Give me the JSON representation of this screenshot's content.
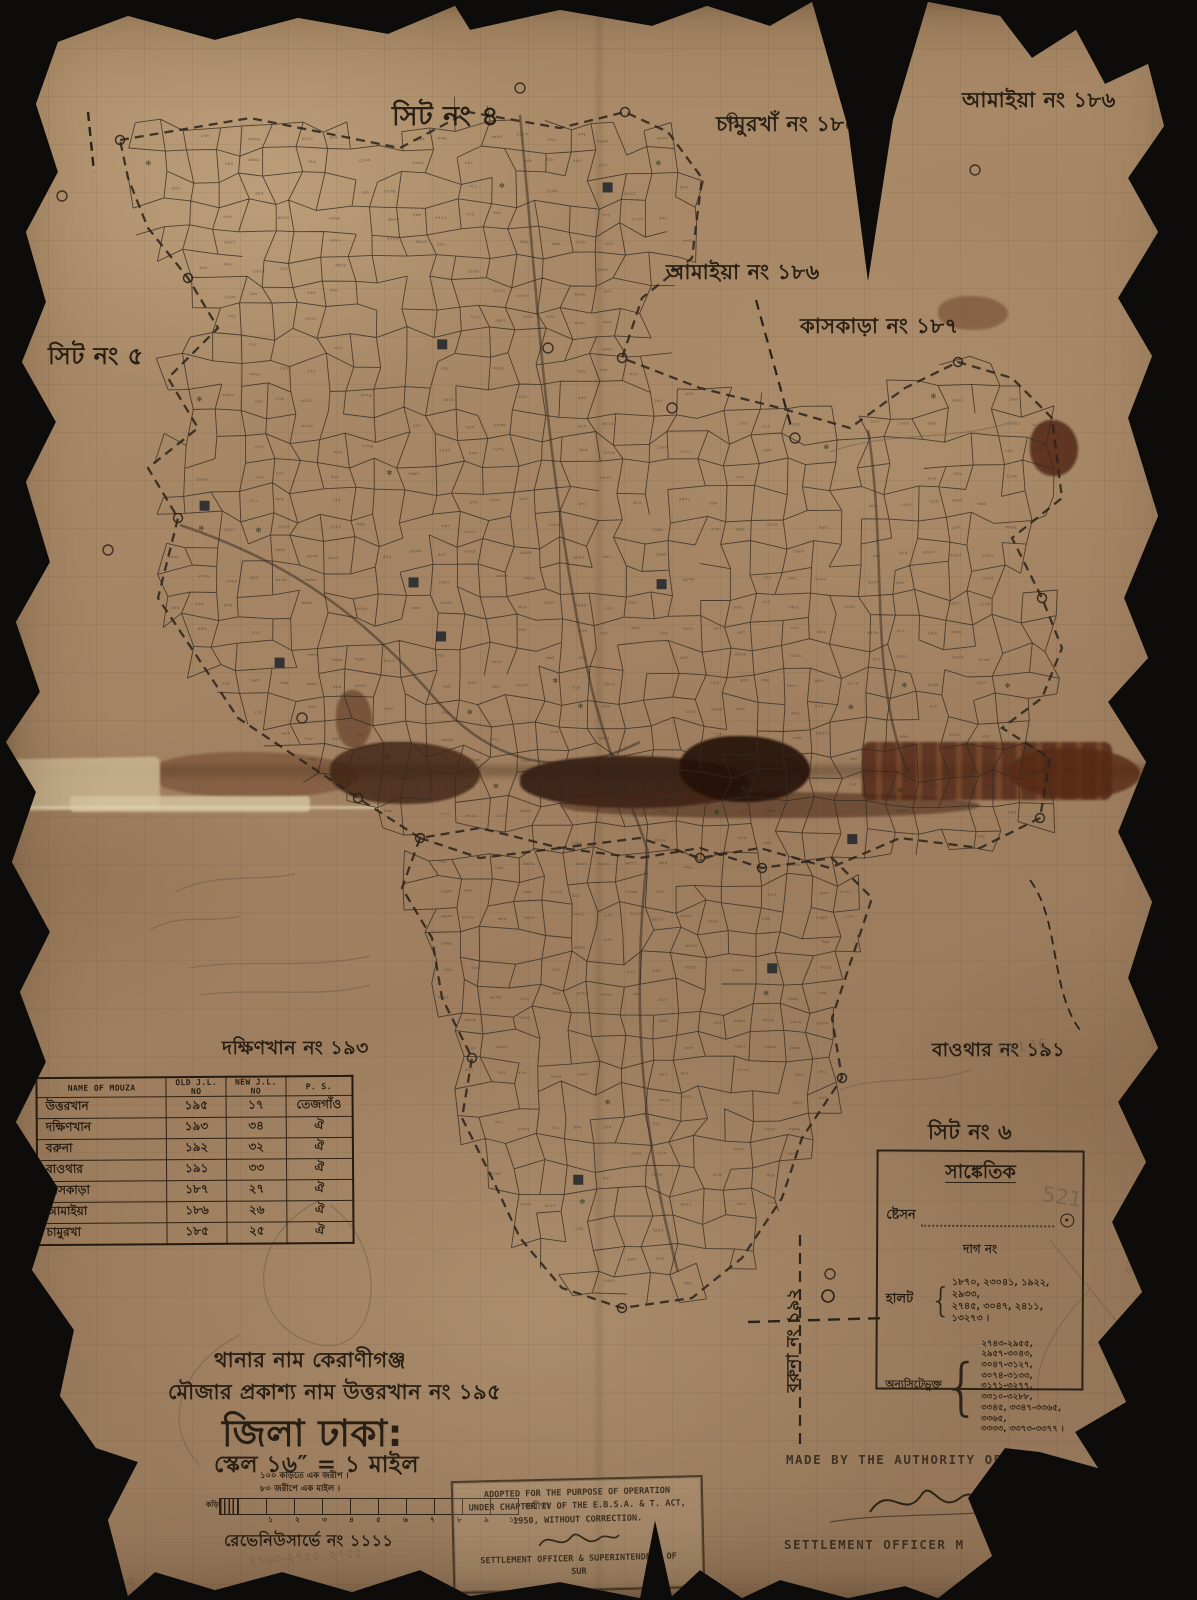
{
  "colors": {
    "background": "#0d0c0a",
    "paper": "#a4855f",
    "ink": "#241c12",
    "typed_ink": "#3e3122",
    "pencil": "#6d5b46"
  },
  "map_labels": {
    "sheet_no_4": "সিট নং ৪",
    "sheet_no_5": "সিট নং ৫",
    "sheet_no_6": "সিট নং ৬",
    "chamurkha_185": "চামুরখাঁ নং ১৮৫",
    "amaiya_186_top": "আমাইয়া নং ১৮৬",
    "amaiya_186_mid": "আমাইয়া নং ১৮৬",
    "kaskara_187": "কাসকাড়া নং ১৮৭",
    "dakshinkhan_193": "দক্ষিণখান নং ১৯৩",
    "baothar_191": "বাওথার নং ১৯১",
    "baruna_192_vertical": "বরুনা নং ১৯২"
  },
  "mouza_table": {
    "headers": [
      "NAME OF MOUZA",
      "OLD J.L. NO",
      "NEW J.L. NO",
      "P. S."
    ],
    "rows": [
      {
        "name": "উত্তরখান",
        "old_jl": "১৯৫",
        "new_jl": "১৭",
        "ps": "তেজগাঁও"
      },
      {
        "name": "দক্ষিণখান",
        "old_jl": "১৯৩",
        "new_jl": "৩৪",
        "ps": "ঐ"
      },
      {
        "name": "বরুনা",
        "old_jl": "১৯২",
        "new_jl": "৩২",
        "ps": "ঐ"
      },
      {
        "name": "বাওথার",
        "old_jl": "১৯১",
        "new_jl": "৩৩",
        "ps": "ঐ"
      },
      {
        "name": "কাসকাড়া",
        "old_jl": "১৮৭",
        "new_jl": "২৭",
        "ps": "ঐ"
      },
      {
        "name": "আমাইয়া",
        "old_jl": "১৮৬",
        "new_jl": "২৬",
        "ps": "ঐ"
      },
      {
        "name": "চামুরখা",
        "old_jl": "১৮৫",
        "new_jl": "২৫",
        "ps": "ঐ"
      }
    ]
  },
  "legend": {
    "title": "সাঙ্কেতিক",
    "station_label": "ষ্টেসন",
    "dag_no_label": "দাগ নং",
    "halot_label": "হালট",
    "halot_numbers_line1": "১৮৭০, ২৩০৪১, ১৯২২, ২৯৩৩,",
    "halot_numbers_line2": "২৭৪৫, ৩০৪৭, ২৪১১, ১৩২৭৩ ।",
    "other_sheet_label": "অন্যসিটেভুক্ত",
    "other_sheet_line1": "২৭৪৩-২৯৫৫, ২৯৫৭-৩০৪৩,",
    "other_sheet_line2": "৩০৪৭-৩১২৭, ৩০৭৪-৩১৩৩,",
    "other_sheet_line3": "৩১৭১-৩২৭৭, ৩৩১০-৩২৮৮,",
    "other_sheet_line4": "৩৩৪৫, ৩৩৪৭-৩৩৬৫, ৩৩৬৫,",
    "other_sheet_line5": "৩৩৩৩, ৩৩৭৩-৩৩৭৭ ।"
  },
  "title_block": {
    "thana_line": "থানার নাম কেরাণীগঞ্জ",
    "mouza_line": "মৌজার প্রকাশ্য নাম  উত্তরখান নং ১৯৫",
    "district_line": "জিলা ঢাকা:",
    "scale_line": "স্কেল ১৬″ = ১ মাইল",
    "revenue_survey_line": "রেভেনিউসার্ভে নং ১১১১"
  },
  "scale_bar": {
    "caption_line1": "১০০ কড়িতে এক জরীপ  ।",
    "caption_line2": "৮০ জরীপে এক মাইল  ।",
    "left_label": "কড়ি",
    "right_label": "জরীপ।",
    "ticks": [
      "১",
      "২",
      "৩",
      "৪",
      "৫",
      "৬",
      "৭",
      "৮",
      "৯",
      "১০"
    ]
  },
  "stamp": {
    "line1": "ADOPTED FOR THE PURPOSE OF OPERATION",
    "line2": "UNDER CHAPTER IV OF THE E.B.S.A. & T. ACT,",
    "line3": "1950, WITHOUT CORRECTION.",
    "line4": "SETTLEMENT OFFICER & SUPERINTENDENT OF",
    "line5": "SUR"
  },
  "credits": {
    "authority_line": "MADE BY THE AUTHORITY OF GO",
    "officer_line": "SETTLEMENT OFFICER M"
  },
  "pencil_notes": {
    "date": "13-1-16",
    "number_521": "521",
    "range_note": "২৭৬০-২৭৫৫, ২৭৫৫",
    "range_note2": "৩২৭৭ - ৩২৭৩",
    "side_number": "৩২৯৭"
  }
}
